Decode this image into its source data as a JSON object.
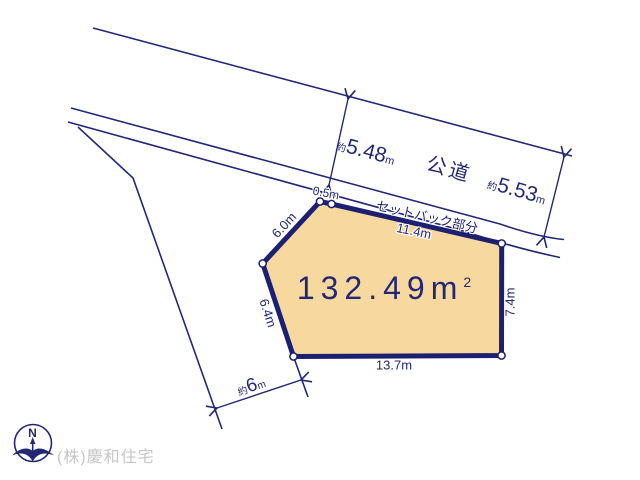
{
  "plan": {
    "area": {
      "value": "132.49",
      "unit": "m",
      "sup": "2"
    },
    "road": {
      "name": "公道",
      "left_width": {
        "prefix": "約",
        "value": "5.48",
        "unit": "m"
      },
      "right_width": {
        "prefix": "約",
        "value": "5.53",
        "unit": "m"
      }
    },
    "setback_label": "セットバック部分",
    "dims": {
      "top_corner": "0.5m",
      "top": "11.4m",
      "upper_left": "6.0m",
      "lower_left": "6.4m",
      "right": "7.4m",
      "bottom": "13.7m",
      "side_road": {
        "prefix": "約",
        "value": "6",
        "unit": "m"
      }
    },
    "compass_n": "N",
    "company": "(株)慶和住宅"
  },
  "colors": {
    "line_navy": "#232875",
    "plot_border": "#1d2070",
    "plot_fill": "#f7d9a0",
    "company_grey": "#c6c6c6"
  }
}
